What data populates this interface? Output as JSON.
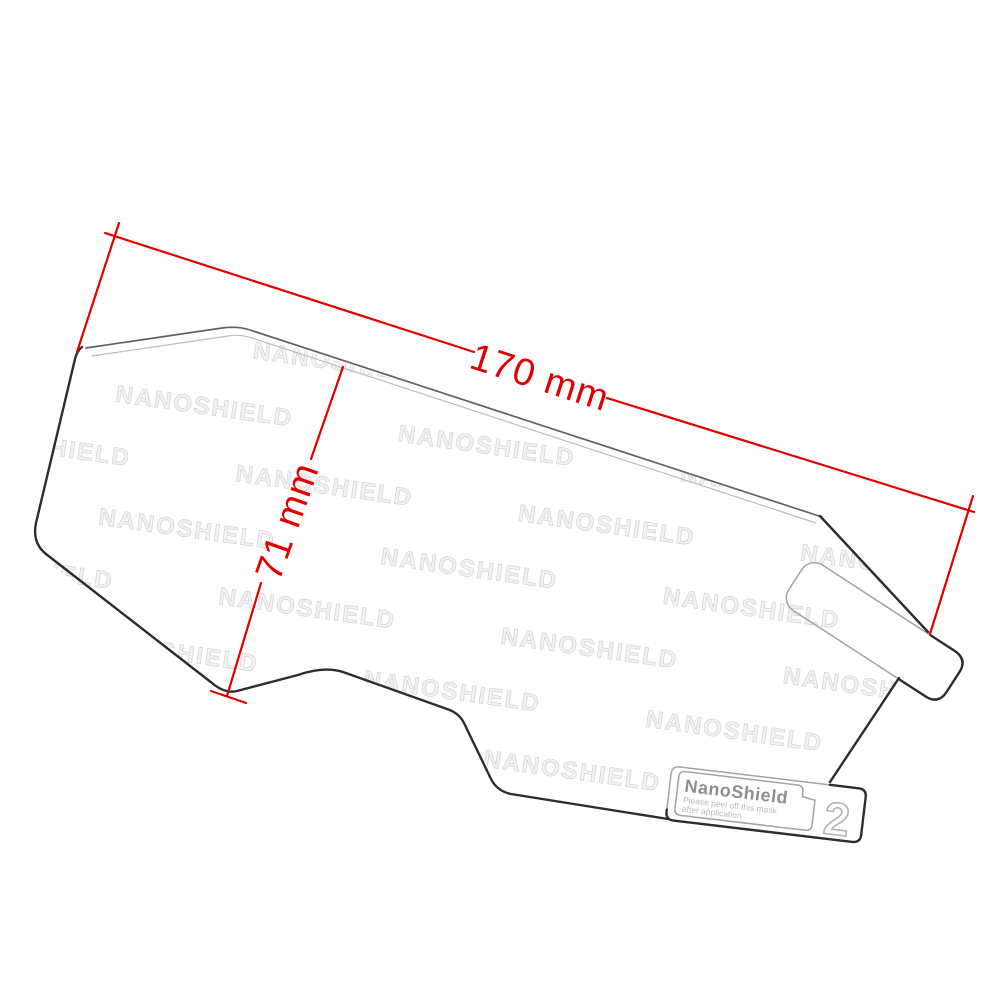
{
  "image": {
    "background": "#ffffff"
  },
  "dimensions": {
    "color": "#e10000",
    "width": {
      "label": "170 mm"
    },
    "height": {
      "label": "71 mm"
    }
  },
  "watermark": {
    "text": "NANOSHIELD"
  },
  "peel_label": {
    "brand": "NanoShield",
    "instruction_line1": "Please peel off this mask",
    "instruction_line2": "after application",
    "step_number": "2"
  },
  "outline": {
    "dark_color": "#2d2d2d",
    "light_color": "#bdbdbd"
  }
}
